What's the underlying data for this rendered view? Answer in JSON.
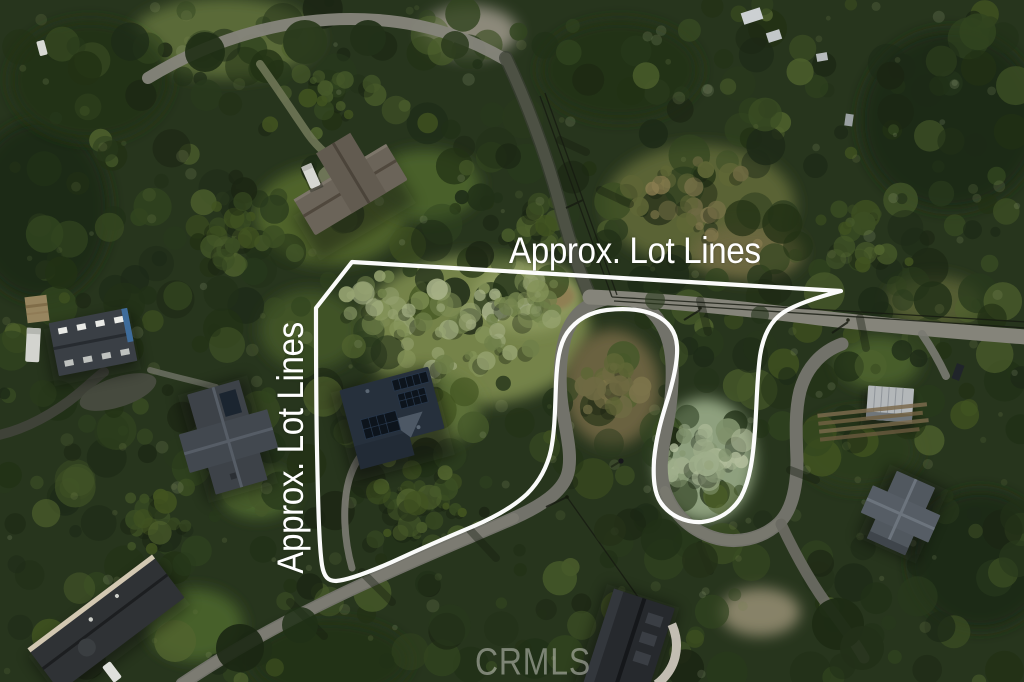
{
  "annotations": {
    "top_label": "Approx. Lot Lines",
    "left_label": "Approx. Lot Lines"
  },
  "watermark": {
    "text": "CRMLS"
  },
  "colors": {
    "lot_line": "#ffffff",
    "label_text": "#ffffff",
    "watermark_text": "rgba(208,208,202,0.52)",
    "forest_dark": "#223017",
    "forest_mid": "#45582a",
    "brush_light": "#8d9a5f",
    "pale_trees": "#9fae8b",
    "road": "#85847a",
    "subject_house_roof": "#26303c"
  },
  "scene": {
    "description": "Aerial photo of wooded residential lots with a winding road, hairpin turn, and white approximate lot line overlay",
    "structures": [
      "subject house with solar panels",
      "barn with skylight rows",
      "neighboring houses",
      "winding road with hairpin turn",
      "power lines"
    ]
  }
}
